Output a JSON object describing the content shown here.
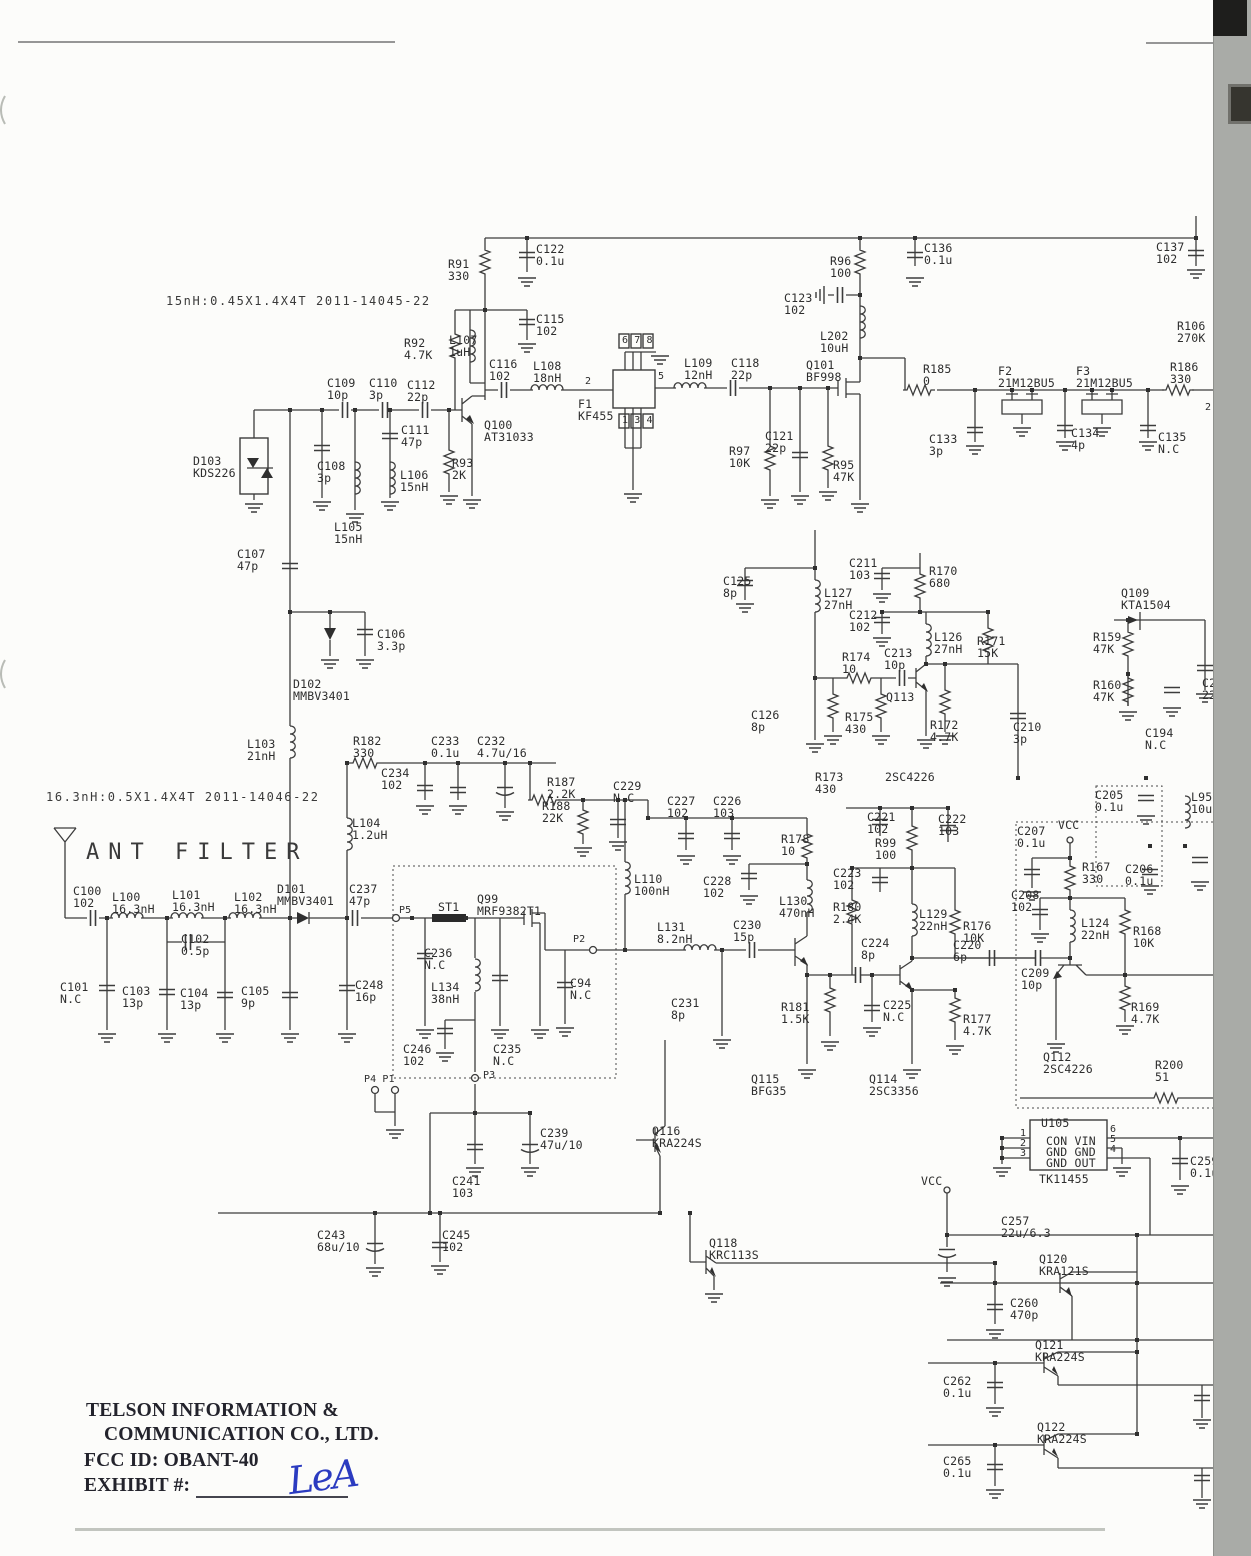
{
  "document": {
    "kind": "scanned RF circuit schematic (FCC exhibit)",
    "section_title": "ANT FILTER",
    "coil_note_1": "15nH:0.45X1.4X4T 2011-14045-22",
    "coil_note_2": "16.3nH:0.5X1.4X4T 2011-14046-22",
    "company_line1": "TELSON INFORMATION &",
    "company_line2": "COMMUNICATION CO., LTD.",
    "fcc_id_line": "FCC ID: OBANT-40",
    "exhibit_line": "EXHIBIT #:",
    "signature": "LeA"
  },
  "colors": {
    "wire": "#3c3c3c",
    "label": "#2d2d2d",
    "signature_blue": "#2b3bc0",
    "scan_strip": "#a9aba7",
    "paper": "#fcfcfa"
  },
  "regulator_ic": {
    "ref": "U105",
    "part": "TK11455",
    "pins_left": [
      "1",
      "2",
      "3"
    ],
    "pins_right": [
      "6",
      "5",
      "4"
    ],
    "pin_rows": [
      "CON VIN",
      "GND GND",
      "GND OUT"
    ]
  },
  "signal_tags": [
    "RX 5V",
    "RX5V",
    "TX 5V",
    "ANT S/W",
    "+7.2V"
  ],
  "labels": [
    {
      "n": "coil-spec-note-1",
      "k": "nt",
      "t": "15nH:0.45X1.4X4T 2011-14045-22",
      "x": 166,
      "y": 295
    },
    {
      "n": "coil-spec-note-2",
      "k": "nt",
      "t": "16.3nH:0.5X1.4X4T 2011-14046-22",
      "x": 46,
      "y": 791
    },
    {
      "t": "C122\n0.1u",
      "x": 536,
      "y": 243
    },
    {
      "t": "R91\n330",
      "x": 448,
      "y": 258
    },
    {
      "t": "C115\n102",
      "x": 536,
      "y": 313
    },
    {
      "t": "R92\n4.7K",
      "x": 404,
      "y": 337
    },
    {
      "t": "L107\n1uH",
      "x": 449,
      "y": 334
    },
    {
      "t": "C116\n102",
      "x": 489,
      "y": 358
    },
    {
      "t": "L108\n18nH",
      "x": 533,
      "y": 360
    },
    {
      "k": "pin",
      "t": "2",
      "x": 585,
      "y": 377
    },
    {
      "k": "pin",
      "t": "5",
      "x": 658,
      "y": 372
    },
    {
      "k": "pin",
      "t": "6 7 8",
      "x": 622,
      "y": 336
    },
    {
      "k": "pin",
      "t": "1 3 4",
      "x": 622,
      "y": 416
    },
    {
      "t": "F1\nKF455",
      "x": 578,
      "y": 398
    },
    {
      "t": "L109\n12nH",
      "x": 684,
      "y": 357
    },
    {
      "t": "C118\n22p",
      "x": 731,
      "y": 357
    },
    {
      "t": "Q101\nBF998",
      "x": 806,
      "y": 359
    },
    {
      "t": "R96\n100",
      "x": 830,
      "y": 255
    },
    {
      "t": "C123\n102",
      "x": 784,
      "y": 292
    },
    {
      "t": "L202\n10uH",
      "x": 820,
      "y": 330
    },
    {
      "t": "C136\n0.1u",
      "x": 924,
      "y": 242
    },
    {
      "t": "C137\n102",
      "x": 1156,
      "y": 241
    },
    {
      "n": "signal-tag-rx5v-top",
      "k": "tagr",
      "t": "RX 5V",
      "x": 1168,
      "y": 200
    },
    {
      "t": "R106\n270K",
      "x": 1177,
      "y": 320
    },
    {
      "t": "R185\n0",
      "x": 923,
      "y": 363
    },
    {
      "t": "F2\n21M12BU5",
      "x": 998,
      "y": 365
    },
    {
      "t": "F3\n21M12BU5",
      "x": 1076,
      "y": 365
    },
    {
      "t": "R186\n330",
      "x": 1170,
      "y": 361
    },
    {
      "t": "C133\n3p",
      "x": 929,
      "y": 433
    },
    {
      "t": "C134\n4p",
      "x": 1071,
      "y": 427
    },
    {
      "t": "C135\nN.C",
      "x": 1158,
      "y": 431
    },
    {
      "k": "pin",
      "t": "2",
      "x": 1205,
      "y": 403
    },
    {
      "t": "Q100\nAT31033",
      "x": 484,
      "y": 419
    },
    {
      "t": "C109\n10p",
      "x": 327,
      "y": 377
    },
    {
      "t": "C110\n3p",
      "x": 369,
      "y": 377
    },
    {
      "t": "C112\n22p",
      "x": 407,
      "y": 379
    },
    {
      "t": "C111\n47p",
      "x": 401,
      "y": 424
    },
    {
      "t": "D103\nKDS226",
      "x": 193,
      "y": 455
    },
    {
      "t": "C108\n3p",
      "x": 317,
      "y": 460
    },
    {
      "t": "L106\n15nH",
      "x": 400,
      "y": 469
    },
    {
      "t": "R93\n2K",
      "x": 452,
      "y": 457
    },
    {
      "t": "R97\n10K",
      "x": 729,
      "y": 445
    },
    {
      "t": "C121\n22p",
      "x": 765,
      "y": 430
    },
    {
      "t": "R95\n47K",
      "x": 833,
      "y": 459
    },
    {
      "t": "L105\n15nH",
      "x": 334,
      "y": 521
    },
    {
      "t": "C107\n47p",
      "x": 237,
      "y": 548
    },
    {
      "t": "C106\n3.3p",
      "x": 377,
      "y": 628
    },
    {
      "t": "D102\nMMBV3401",
      "x": 293,
      "y": 678
    },
    {
      "t": "L103\n21nH",
      "x": 247,
      "y": 738
    },
    {
      "t": "R182\n330",
      "x": 353,
      "y": 735
    },
    {
      "t": "C233\n0.1u",
      "x": 431,
      "y": 735
    },
    {
      "t": "C232\n4.7u/16",
      "x": 477,
      "y": 735
    },
    {
      "t": "C234\n102",
      "x": 381,
      "y": 767
    },
    {
      "t": "R187\n2.2K",
      "x": 547,
      "y": 776
    },
    {
      "t": "R188\n22K",
      "x": 542,
      "y": 800
    },
    {
      "n": "signal-tag-ant-sw-mid",
      "k": "tagl",
      "t": "ANT S/W",
      "x": 556,
      "y": 756
    },
    {
      "t": "C229\nN.C",
      "x": 613,
      "y": 780
    },
    {
      "t": "L104\n1.2uH",
      "x": 352,
      "y": 817
    },
    {
      "n": "schematic-section-title",
      "k": "t1",
      "t": "ANT FILTER",
      "x": 86,
      "y": 841
    },
    {
      "t": "C100\n102",
      "x": 73,
      "y": 885
    },
    {
      "t": "L100\n16.3nH",
      "x": 112,
      "y": 891
    },
    {
      "t": "L101\n16.3nH",
      "x": 172,
      "y": 889
    },
    {
      "t": "L102\n16.3nH",
      "x": 234,
      "y": 891
    },
    {
      "t": "D101\nMMBV3401",
      "x": 277,
      "y": 883
    },
    {
      "t": "C237\n47p",
      "x": 349,
      "y": 883
    },
    {
      "t": "C102\n0.5p",
      "x": 181,
      "y": 933
    },
    {
      "t": "C101\nN.C",
      "x": 60,
      "y": 981
    },
    {
      "t": "C103\n13p",
      "x": 122,
      "y": 985
    },
    {
      "t": "C104\n13p",
      "x": 180,
      "y": 987
    },
    {
      "t": "C105\n9p",
      "x": 241,
      "y": 985
    },
    {
      "t": "C248\n16p",
      "x": 355,
      "y": 979
    },
    {
      "k": "pin",
      "t": "P5",
      "x": 399,
      "y": 906
    },
    {
      "t": "ST1",
      "x": 438,
      "y": 901
    },
    {
      "t": "Q99\nMRF9382T1",
      "x": 477,
      "y": 893
    },
    {
      "t": "C236\nN.C",
      "x": 424,
      "y": 947
    },
    {
      "t": "L134\n38nH",
      "x": 431,
      "y": 981
    },
    {
      "t": "C94\nN.C",
      "x": 570,
      "y": 977
    },
    {
      "k": "pin",
      "t": "P2",
      "x": 573,
      "y": 935
    },
    {
      "t": "C235\nN.C",
      "x": 493,
      "y": 1043
    },
    {
      "t": "C246\n102",
      "x": 403,
      "y": 1043
    },
    {
      "k": "pin",
      "t": "P3",
      "x": 483,
      "y": 1071
    },
    {
      "k": "pin",
      "t": "P4 P1",
      "x": 364,
      "y": 1075
    },
    {
      "t": "L110\n100nH",
      "x": 634,
      "y": 873
    },
    {
      "t": "L131\n8.2nH",
      "x": 657,
      "y": 921
    },
    {
      "t": "C230\n15p",
      "x": 733,
      "y": 919
    },
    {
      "t": "C231\n8p",
      "x": 671,
      "y": 997
    },
    {
      "t": "C227\n102",
      "x": 667,
      "y": 795
    },
    {
      "t": "C226\n103",
      "x": 713,
      "y": 795
    },
    {
      "t": "R178\n10",
      "x": 781,
      "y": 833
    },
    {
      "t": "C228\n102",
      "x": 703,
      "y": 875
    },
    {
      "t": "L130\n470nH",
      "x": 779,
      "y": 895
    },
    {
      "t": "R180\n2.4K",
      "x": 833,
      "y": 901
    },
    {
      "t": "C223\n102",
      "x": 833,
      "y": 867
    },
    {
      "t": "R99\n100",
      "x": 875,
      "y": 837
    },
    {
      "t": "C221\n102",
      "x": 867,
      "y": 811
    },
    {
      "t": "C222\n103",
      "x": 938,
      "y": 813
    },
    {
      "t": "L129\n22nH",
      "x": 919,
      "y": 908
    },
    {
      "t": "R176\n10K",
      "x": 963,
      "y": 920
    },
    {
      "t": "C224\n8p",
      "x": 861,
      "y": 937
    },
    {
      "t": "C225\nN.C",
      "x": 883,
      "y": 999
    },
    {
      "t": "R181\n1.5K",
      "x": 781,
      "y": 1001
    },
    {
      "t": "Q115\nBFG35",
      "x": 751,
      "y": 1073
    },
    {
      "t": "Q114\n2SC3356",
      "x": 869,
      "y": 1073
    },
    {
      "t": "C220\n6p",
      "x": 953,
      "y": 939
    },
    {
      "t": "R177\n4.7K",
      "x": 963,
      "y": 1013
    },
    {
      "t": "R173\n430",
      "x": 815,
      "y": 771
    },
    {
      "t": "C125\n8p",
      "x": 723,
      "y": 575
    },
    {
      "t": "L127\n27nH",
      "x": 824,
      "y": 587
    },
    {
      "t": "C211\n103",
      "x": 849,
      "y": 557
    },
    {
      "n": "signal-tag-rx5v-mid",
      "k": "tagl",
      "t": "RX5V",
      "x": 920,
      "y": 545
    },
    {
      "t": "R170\n680",
      "x": 929,
      "y": 565
    },
    {
      "t": "C212\n102",
      "x": 849,
      "y": 609
    },
    {
      "t": "L126\n27nH",
      "x": 934,
      "y": 631
    },
    {
      "t": "R171\n15K",
      "x": 977,
      "y": 635
    },
    {
      "t": "R174\n10",
      "x": 842,
      "y": 651
    },
    {
      "t": "C213\n10p",
      "x": 884,
      "y": 647
    },
    {
      "t": "Q113",
      "x": 886,
      "y": 691
    },
    {
      "t": "C126\n8p",
      "x": 751,
      "y": 709
    },
    {
      "t": "R175\n430",
      "x": 845,
      "y": 711
    },
    {
      "t": "R172\n4.7K",
      "x": 930,
      "y": 719
    },
    {
      "t": "C210\n3p",
      "x": 1013,
      "y": 721
    },
    {
      "t": "2SC4226",
      "x": 885,
      "y": 771
    },
    {
      "n": "signal-tag-rx5v-right",
      "k": "tagr",
      "t": "RX 5V",
      "x": 1052,
      "y": 612
    },
    {
      "n": "signal-tag-tx5v-mid",
      "k": "tagr",
      "t": "TX 5V",
      "x": 974,
      "y": 770
    },
    {
      "t": "Q109\nKTA1504",
      "x": 1121,
      "y": 587
    },
    {
      "t": "R159\n47K",
      "x": 1093,
      "y": 631
    },
    {
      "t": "R160\n47K",
      "x": 1093,
      "y": 679
    },
    {
      "t": "C194\nN.C",
      "x": 1145,
      "y": 727
    },
    {
      "t": "C2\n22u",
      "x": 1202,
      "y": 677
    },
    {
      "t": "C205\n0.1u",
      "x": 1095,
      "y": 789
    },
    {
      "t": "L95\n10uH",
      "x": 1191,
      "y": 791
    },
    {
      "t": "VCC",
      "x": 1058,
      "y": 819
    },
    {
      "t": "C207\n0.1u",
      "x": 1017,
      "y": 825
    },
    {
      "t": "R167\n330",
      "x": 1082,
      "y": 861
    },
    {
      "t": "C206\n0.1u",
      "x": 1125,
      "y": 863
    },
    {
      "t": "C208\n102",
      "x": 1011,
      "y": 889
    },
    {
      "t": "L124\n22nH",
      "x": 1081,
      "y": 917
    },
    {
      "t": "R168\n10K",
      "x": 1133,
      "y": 925
    },
    {
      "t": "C209\n10p",
      "x": 1021,
      "y": 967
    },
    {
      "t": "R169\n4.7K",
      "x": 1131,
      "y": 1001
    },
    {
      "t": "Q112\n2SC4226",
      "x": 1043,
      "y": 1051
    },
    {
      "t": "R200\n51",
      "x": 1155,
      "y": 1059
    },
    {
      "t": "U105",
      "x": 1041,
      "y": 1117
    },
    {
      "t": "CON VIN",
      "x": 1046,
      "y": 1135
    },
    {
      "t": "GND GND",
      "x": 1046,
      "y": 1146
    },
    {
      "t": "GND OUT",
      "x": 1046,
      "y": 1157
    },
    {
      "t": "TK11455",
      "x": 1039,
      "y": 1173
    },
    {
      "k": "pin",
      "t": "1",
      "x": 1020,
      "y": 1129
    },
    {
      "k": "pin",
      "t": "2",
      "x": 1020,
      "y": 1139
    },
    {
      "k": "pin",
      "t": "3",
      "x": 1020,
      "y": 1149
    },
    {
      "k": "pin",
      "t": "6",
      "x": 1110,
      "y": 1125
    },
    {
      "k": "pin",
      "t": "5",
      "x": 1110,
      "y": 1135
    },
    {
      "k": "pin",
      "t": "4",
      "x": 1110,
      "y": 1145
    },
    {
      "t": "C259\n0.1u",
      "x": 1190,
      "y": 1155
    },
    {
      "t": "VCC",
      "x": 921,
      "y": 1175
    },
    {
      "t": "C257\n22u/6.3",
      "x": 1001,
      "y": 1215
    },
    {
      "t": "Q120\nKRA121S",
      "x": 1039,
      "y": 1253
    },
    {
      "t": "C260\n470p",
      "x": 1010,
      "y": 1297
    },
    {
      "n": "signal-tag-ant-sw-bottom",
      "k": "tagl",
      "t": "ANT S/W",
      "x": 864,
      "y": 1275
    },
    {
      "t": "Q116\nKRA224S",
      "x": 652,
      "y": 1125
    },
    {
      "t": "Q118\nKRC113S",
      "x": 709,
      "y": 1237
    },
    {
      "n": "signal-tag-72v",
      "k": "tagr",
      "t": "+7.2V",
      "x": 154,
      "y": 1205
    },
    {
      "t": "C243\n68u/10",
      "x": 317,
      "y": 1229
    },
    {
      "t": "C245\n102",
      "x": 442,
      "y": 1229
    },
    {
      "t": "C239\n47u/10",
      "x": 540,
      "y": 1127
    },
    {
      "t": "C241\n103",
      "x": 452,
      "y": 1175
    },
    {
      "t": "Q121\nKRA224S",
      "x": 1035,
      "y": 1339
    },
    {
      "n": "signal-tag-tx5v-bottom",
      "k": "tagl",
      "t": "TX 5V",
      "x": 862,
      "y": 1355
    },
    {
      "t": "C262\n0.1u",
      "x": 943,
      "y": 1375
    },
    {
      "t": "Q122\nKRA224S",
      "x": 1037,
      "y": 1421
    },
    {
      "n": "signal-tag-rx5v-bottom",
      "k": "tagl",
      "t": "RX 5V",
      "x": 862,
      "y": 1437
    },
    {
      "t": "C265\n0.1u",
      "x": 943,
      "y": 1455
    },
    {
      "n": "footer-company-line1",
      "k": "ser",
      "t": "TELSON INFORMATION &",
      "x": 86,
      "y": 1401
    },
    {
      "n": "footer-company-line2",
      "k": "ser",
      "t": "COMMUNICATION CO., LTD.",
      "x": 104,
      "y": 1425
    },
    {
      "n": "footer-fcc-id",
      "k": "ser",
      "t": "FCC ID: OBANT-40",
      "x": 84,
      "y": 1451
    },
    {
      "n": "footer-exhibit",
      "k": "ser",
      "t": "EXHIBIT #:",
      "x": 84,
      "y": 1476
    },
    {
      "n": "exhibit-signature",
      "k": "hand",
      "t": "LeA",
      "x": 288,
      "y": 1455
    }
  ]
}
